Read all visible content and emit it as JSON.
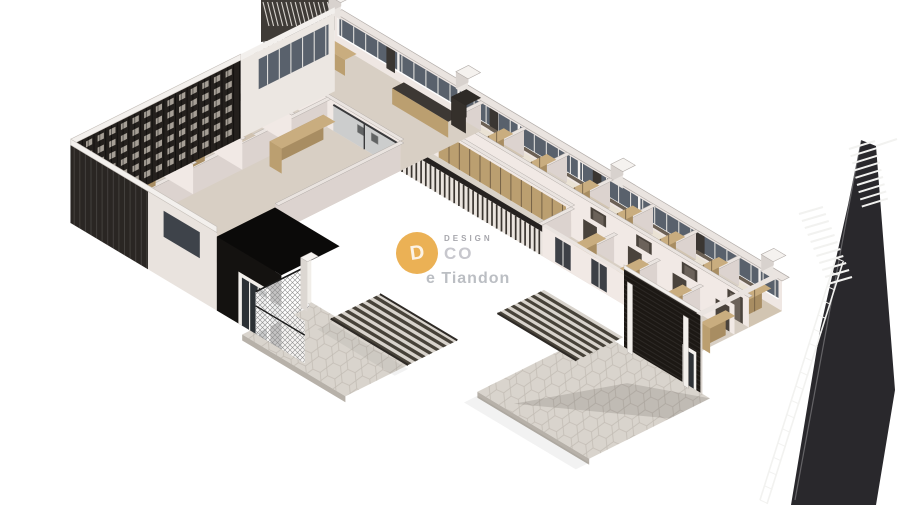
{
  "meta": {
    "title": "Isometric cutaway 3D floor plan rendering",
    "scene": "office-hotel floor plan axonometric render on white background"
  },
  "watermark": {
    "logo_letter": "D",
    "brand_small": "DESIGN",
    "brand_main": "CO",
    "subtext": "e Tiandon",
    "gold": "#e6a030"
  },
  "palette": {
    "background": "#ffffff",
    "wall_light": "#f1e9e5",
    "wall_shadow": "#dcd3cf",
    "wall_top": "#eae4e0",
    "wall_edge": "#b2aca8",
    "back_wall": "#efe7e3",
    "floor": "#d8cfc4",
    "floor_warm": "#d2c5b2",
    "corridor": "#d7cec3",
    "wood_top": "#c9ad7f",
    "wood_side": "#a88d62",
    "wood_front": "#bb9f70",
    "wood_seam": "#6e5b42",
    "bed_top": "#eae2d4",
    "bed_side": "#d6cdbf",
    "headboard": "#6b6054",
    "dark_box": "#4e473f",
    "black": "#141210",
    "canopy": "#0b0a09",
    "brick": "#1c1814",
    "louver": "#24201d",
    "louver_fin": "#4a453f",
    "slit": "#bdb6ac",
    "glass": "#59616c",
    "glass_light": "#8f99a4",
    "mullion": "#eceae6",
    "paving": "#d9d4cd",
    "paving_edge": "#b7b1a9",
    "paving_line": "#c3bdb5",
    "stripe_dark": "#474239",
    "stripe_light": "#d8d3cc",
    "fascia": "#f3f0ed",
    "pylon": "#29282c",
    "rung": "#f2f2f0",
    "shadow": "rgba(60,55,50,0.16)"
  }
}
